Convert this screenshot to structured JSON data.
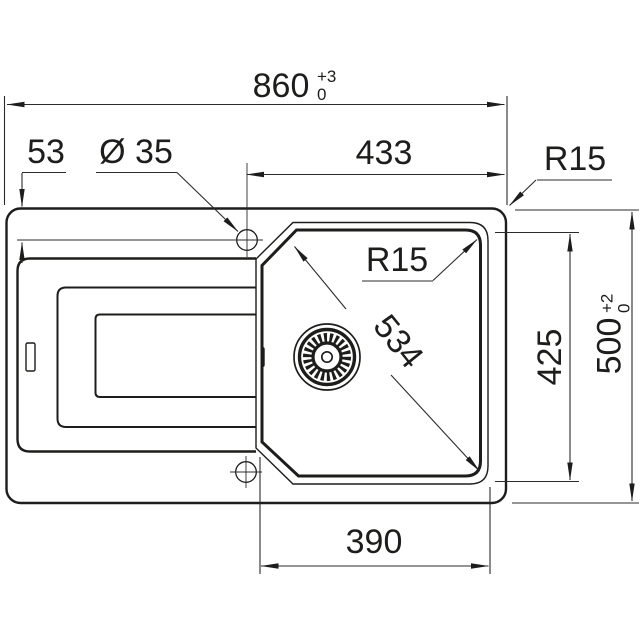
{
  "colors": {
    "line": "#1d1d1b",
    "background": "#ffffff"
  },
  "drawing": {
    "dims": {
      "overall_width": {
        "value": "860",
        "tol_plus": "+3",
        "tol_minus": "0"
      },
      "overall_depth": {
        "value": "500",
        "tol_plus": "+2",
        "tol_minus": "0"
      },
      "tap_hole_offset": {
        "value": "53"
      },
      "tap_hole_diameter": {
        "value": "Ø 35"
      },
      "tap_to_right_edge": {
        "value": "433"
      },
      "outer_corner_radius": {
        "value": "R15"
      },
      "bowl_corner_radius": {
        "value": "R15"
      },
      "bowl_diagonal": {
        "value": "534"
      },
      "bowl_front_to_back": {
        "value": "425"
      },
      "bowl_width": {
        "value": "390"
      }
    }
  }
}
